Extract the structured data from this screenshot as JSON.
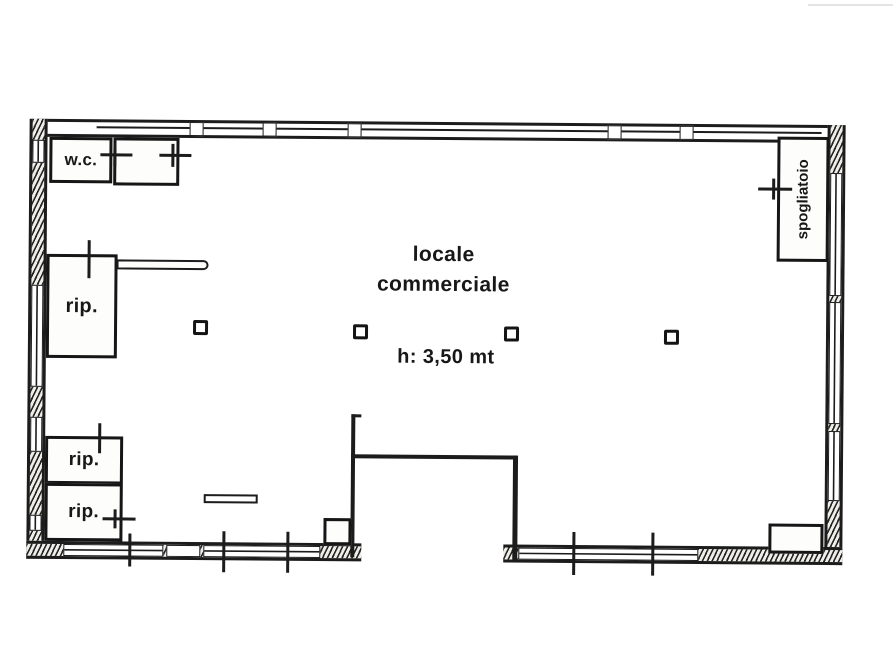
{
  "plan": {
    "type": "floor-plan",
    "ink_color": "#1c1c1c",
    "paper_color": "#ffffff",
    "rooms": {
      "wc_label": "w.c.",
      "storage1_label": "rip.",
      "storage2_label": "rip.",
      "storage3_label": "rip.",
      "changing_room_label": "spogliatoio",
      "main_room_label_line1": "locale",
      "main_room_label_line2": "commerciale",
      "ceiling_height_label": "h: 3,50 mt"
    }
  }
}
